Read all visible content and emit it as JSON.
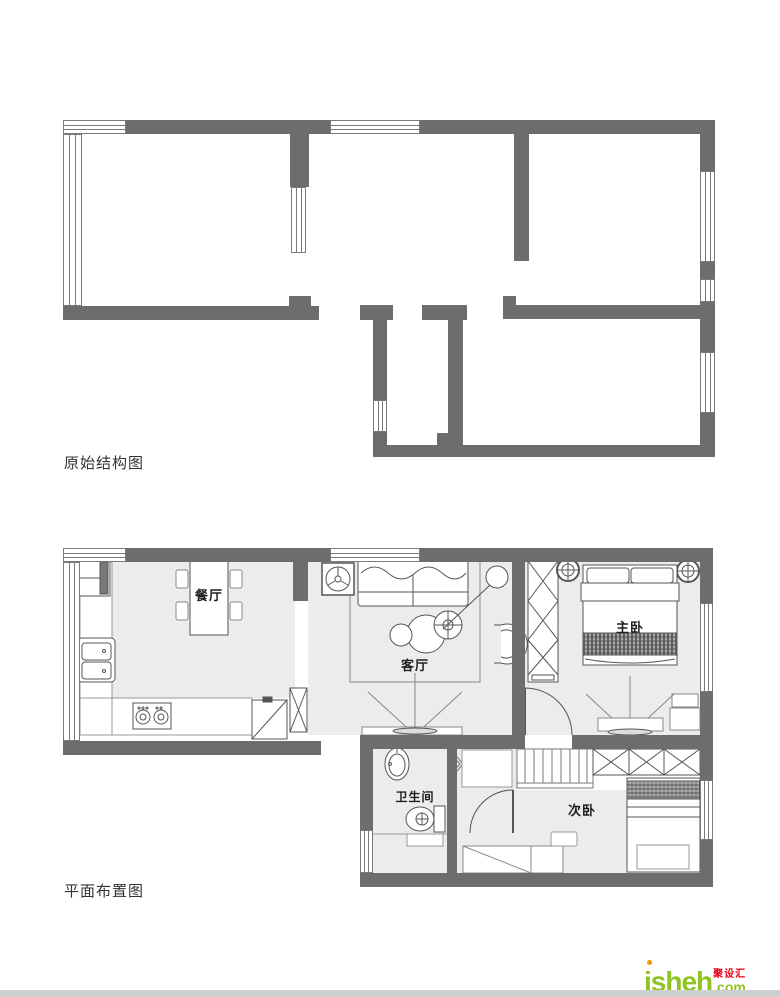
{
  "captions": {
    "plan1": "原始结构图",
    "plan2": "平面布置图"
  },
  "rooms": {
    "dining": "餐厅",
    "living": "客厅",
    "master": "主卧",
    "bath": "卫生间",
    "second": "次卧"
  },
  "logo": {
    "brand": "jsheh",
    "suffix": ".com",
    "tagline": "聚设汇"
  },
  "colors": {
    "wall": "#6d6d6d",
    "floor": "#ececec",
    "stroke": "#555555",
    "logo_green": "#8fc31f",
    "logo_orange": "#f39800",
    "logo_red": "#e60012"
  },
  "icons": [
    "window-icon",
    "fridge-icon",
    "kitchen-sink-icon",
    "stove-icon",
    "dining-table-icon",
    "chair-icon",
    "cabinet-x-icon",
    "fan-unit-icon",
    "sofa-icon",
    "rug-icon",
    "coffee-table-icon",
    "floor-lamp-icon",
    "armchair-icon",
    "tv-icon",
    "wardrobe-icon",
    "ceiling-lamp-icon",
    "double-bed-icon",
    "nightstand-icon",
    "door-swing-icon",
    "wash-basin-icon",
    "toilet-icon",
    "shower-screen-icon",
    "washer-icon",
    "shoe-cabinet-icon",
    "single-bed-icon",
    "desk-icon",
    "stool-icon"
  ]
}
